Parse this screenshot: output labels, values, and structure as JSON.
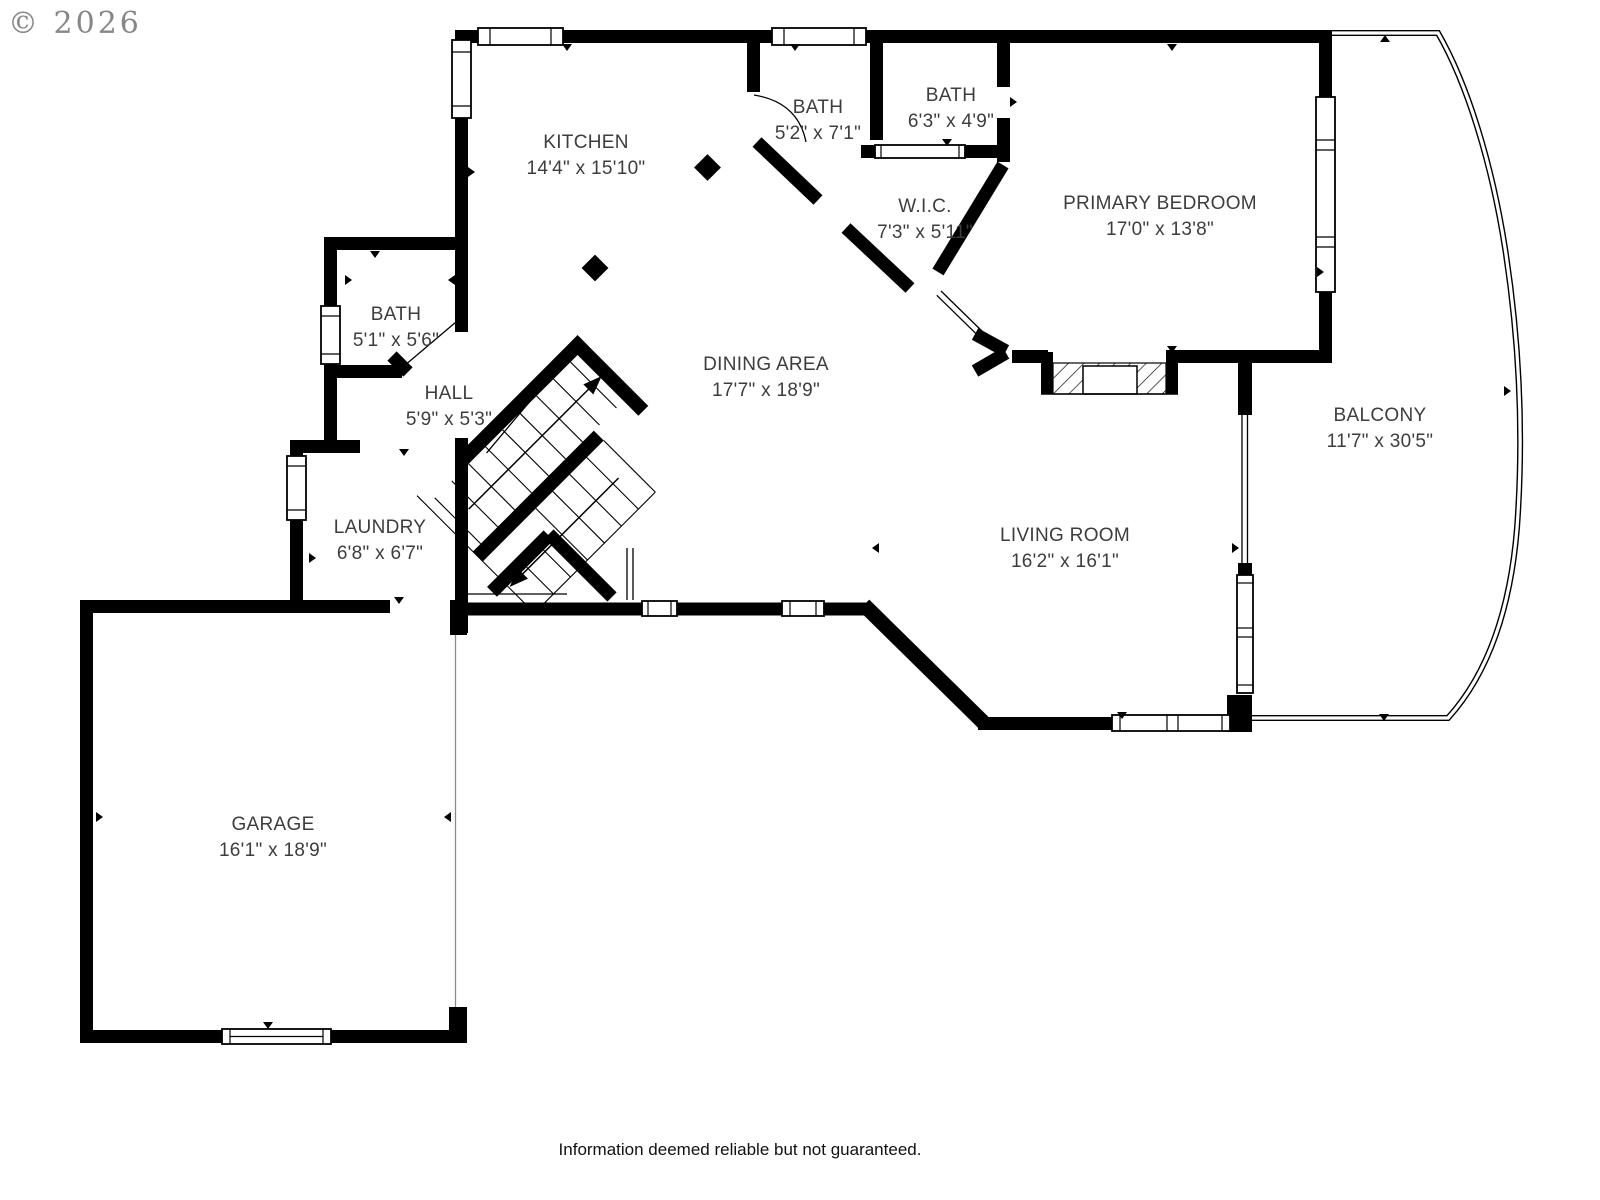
{
  "watermark": {
    "text": "© 2026"
  },
  "footer": {
    "disclaimer": "Information deemed reliable but not guaranteed."
  },
  "colors": {
    "wall": "#000000",
    "label_text": "#3d3d3d",
    "watermark": "#878787",
    "background": "#ffffff"
  },
  "floor_plan": {
    "rooms": [
      {
        "id": "kitchen",
        "name": "KITCHEN",
        "dimensions": "14'4\" x 15'10\""
      },
      {
        "id": "bath-upper",
        "name": "BATH",
        "dimensions": "5'2\" x 7'1\""
      },
      {
        "id": "bath-small",
        "name": "BATH",
        "dimensions": "6'3\" x 4'9\""
      },
      {
        "id": "primary-bedroom",
        "name": "PRIMARY BEDROOM",
        "dimensions": "17'0\" x 13'8\""
      },
      {
        "id": "wic",
        "name": "W.I.C.",
        "dimensions": "7'3\" x 5'11\""
      },
      {
        "id": "dining-area",
        "name": "DINING AREA",
        "dimensions": "17'7\" x 18'9\""
      },
      {
        "id": "bath-lower",
        "name": "BATH",
        "dimensions": "5'1\" x 5'6\""
      },
      {
        "id": "hall",
        "name": "HALL",
        "dimensions": "5'9\" x 5'3\""
      },
      {
        "id": "laundry",
        "name": "LAUNDRY",
        "dimensions": "6'8\" x 6'7\""
      },
      {
        "id": "living-room",
        "name": "LIVING ROOM",
        "dimensions": "16'2\" x 16'1\""
      },
      {
        "id": "balcony",
        "name": "BALCONY",
        "dimensions": "11'7\" x 30'5\""
      },
      {
        "id": "garage",
        "name": "GARAGE",
        "dimensions": "16'1\" x 18'9\""
      }
    ]
  }
}
